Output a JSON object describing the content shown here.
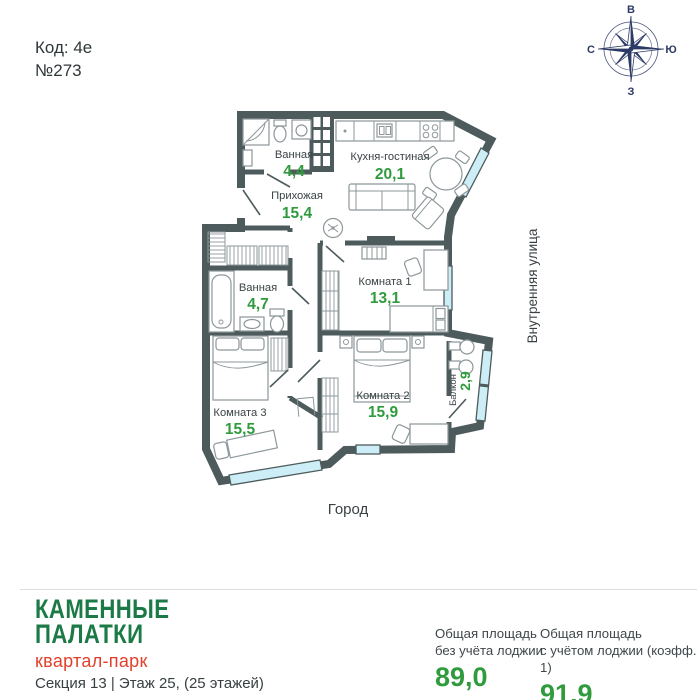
{
  "meta": {
    "code": "Код: 4е",
    "number": "№273"
  },
  "compass": {
    "top": "В",
    "left": "С",
    "right": "Ю",
    "bottom": "З",
    "color": "#2c3a66"
  },
  "plan": {
    "rooms": [
      {
        "id": "bath1",
        "name": "Ванная",
        "area": "4,4"
      },
      {
        "id": "kitchen",
        "name": "Кухня-гостиная",
        "area": "20,1"
      },
      {
        "id": "hall",
        "name": "Прихожая",
        "area": "15,4"
      },
      {
        "id": "bath2",
        "name": "Ванная",
        "area": "4,7"
      },
      {
        "id": "room1",
        "name": "Комната 1",
        "area": "13,1"
      },
      {
        "id": "room2",
        "name": "Комната 2",
        "area": "15,9"
      },
      {
        "id": "room3",
        "name": "Комната 3",
        "area": "15,5"
      },
      {
        "id": "balcony",
        "name": "Балкон",
        "area": "2,9"
      }
    ],
    "street_right": "Внутренняя улица",
    "street_bottom": "Город",
    "colors": {
      "wall": "#4d5b5d",
      "window": "#cdeef6",
      "area_green": "#2f9b3d"
    }
  },
  "footer": {
    "logo_line1": "КАМЕННЫЕ",
    "logo_line2": "ПАЛАТКИ",
    "logo_sub": "квартал-парк",
    "section_info": "Секция 13 | Этаж 25, (25 этажей)",
    "stats": [
      {
        "label_line1": "Общая площадь",
        "label_line2": "без учёта лоджии",
        "value": "89,0"
      },
      {
        "label_line1": "Общая площадь",
        "label_line2": "с учётом лоджии (коэфф. 1)",
        "value": "91,9"
      }
    ]
  }
}
